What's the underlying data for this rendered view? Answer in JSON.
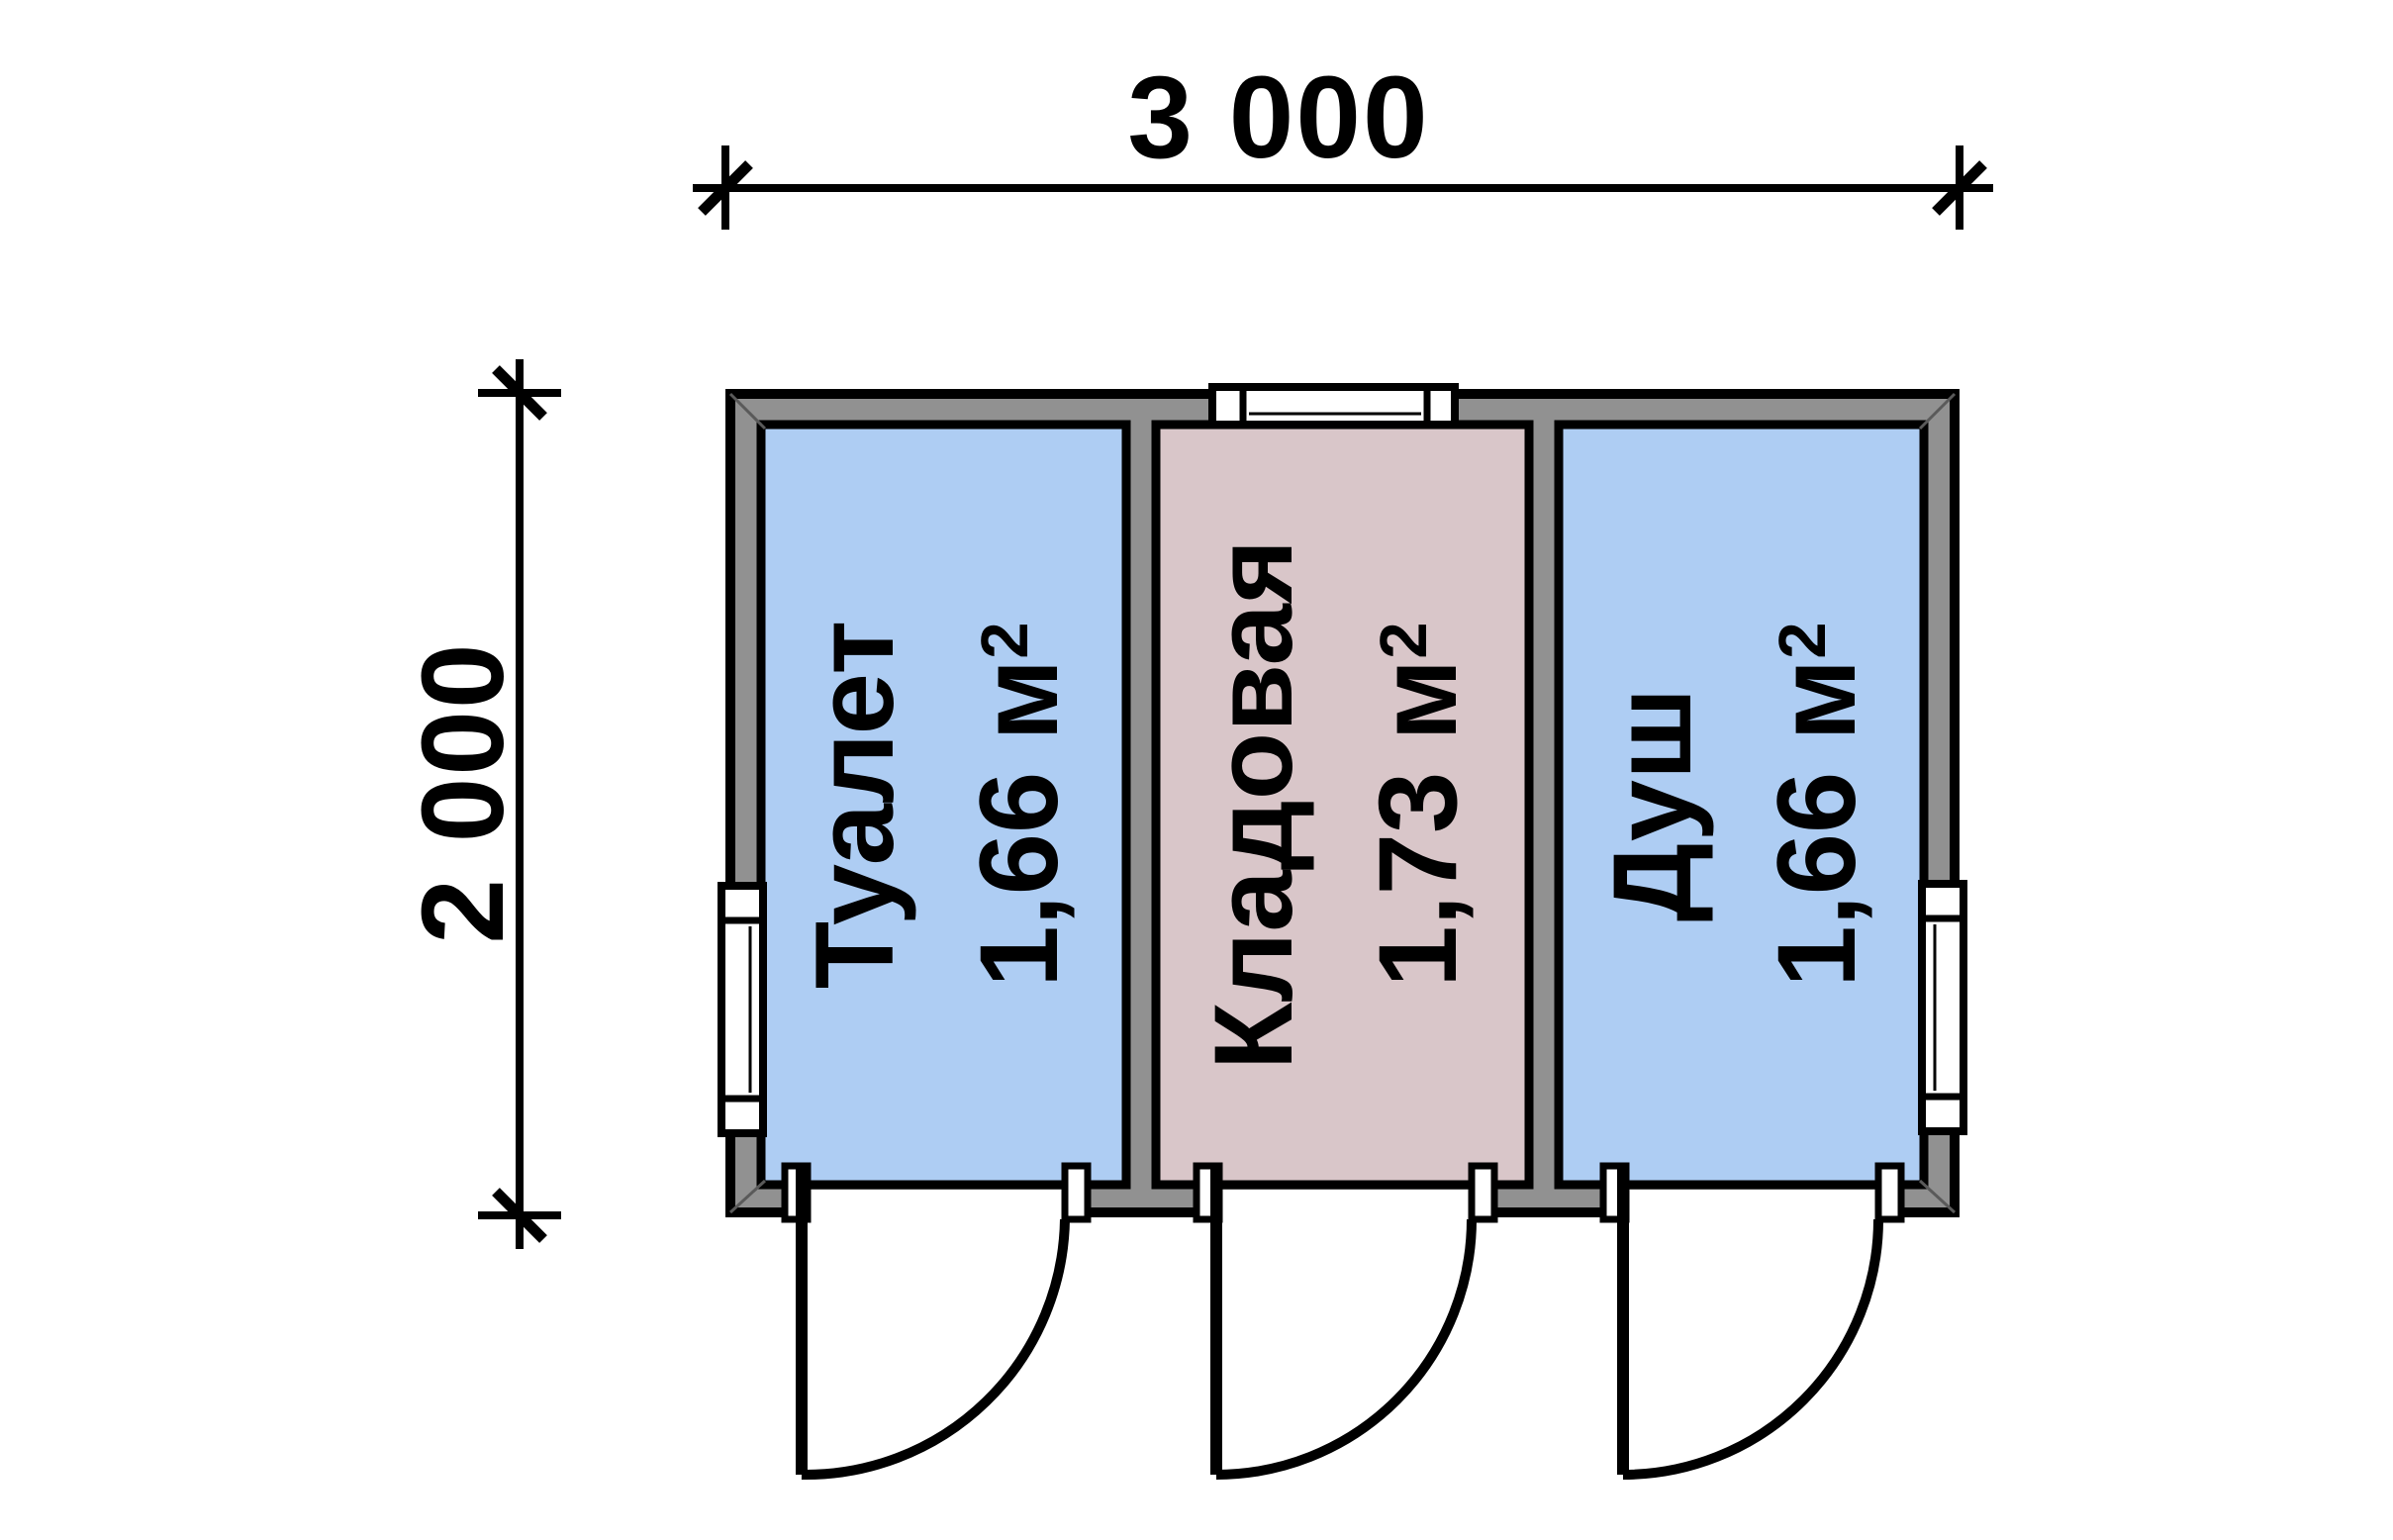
{
  "drawing": {
    "type": "floor-plan",
    "dimensions": {
      "width_label": "3 000",
      "height_label": "2 000"
    },
    "rooms": [
      {
        "name": "Туалет",
        "area_value": "1,66 м",
        "area_sup": "2",
        "color": "#aecdf3"
      },
      {
        "name": "Кладовая",
        "area_value": "1,73 м",
        "area_sup": "2",
        "color": "#d9c6c9"
      },
      {
        "name": "Душ",
        "area_value": "1,66 м",
        "area_sup": "2",
        "color": "#aecdf3"
      }
    ],
    "colors": {
      "wall": "#919191",
      "line": "#000000",
      "background": "#ffffff",
      "window": "#ffffff"
    }
  }
}
